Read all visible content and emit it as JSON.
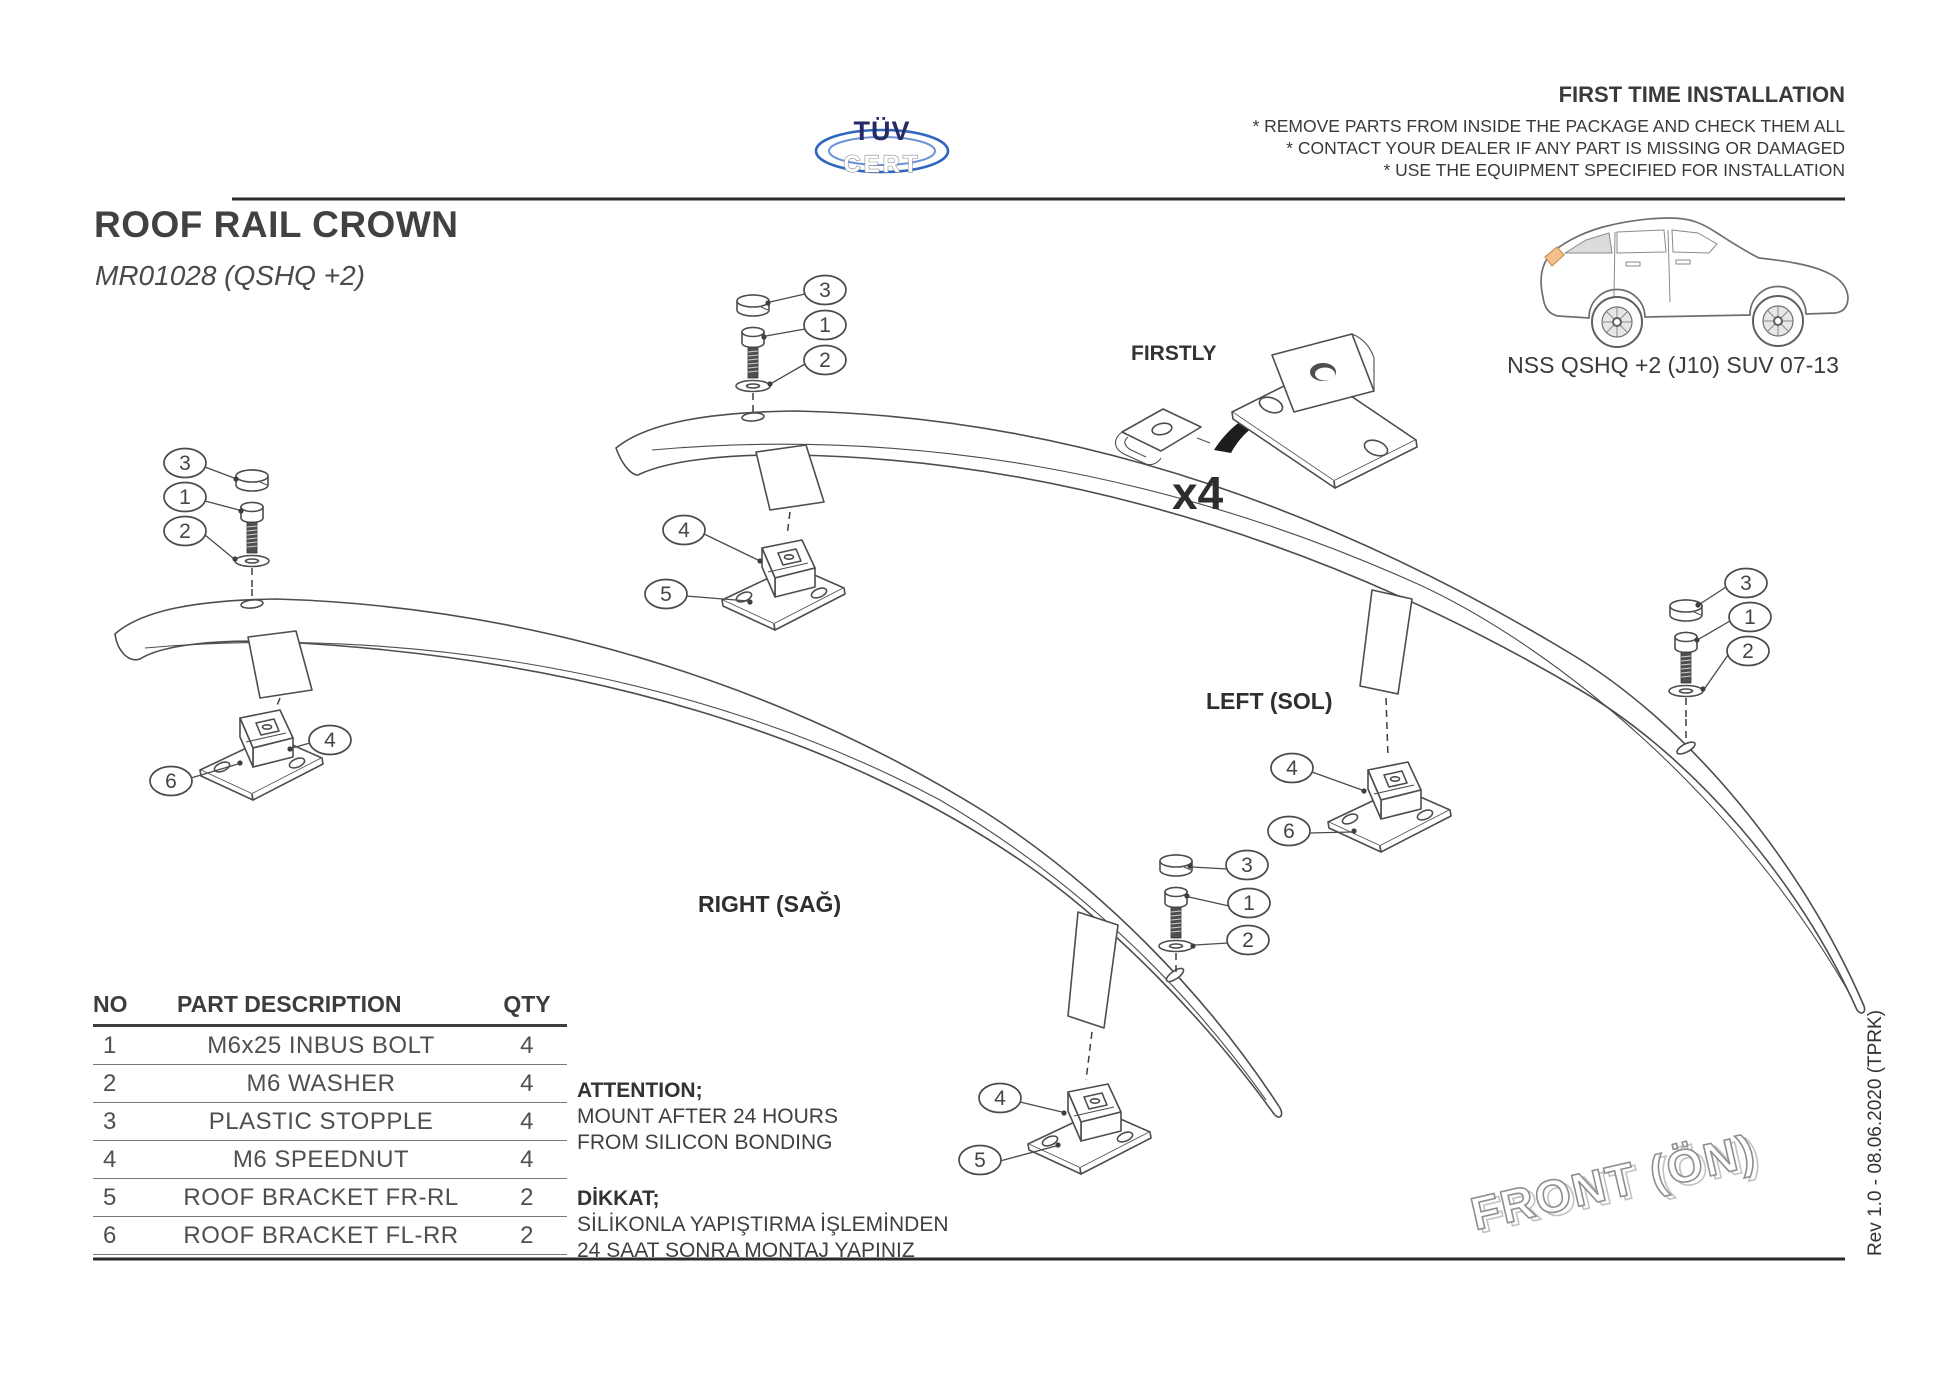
{
  "colors": {
    "accent_blue": "#2f66c0",
    "logo_navy": "#262b66",
    "line_art_gray": "#4d4d4d",
    "text_dark": "#3a3a3a",
    "taillight_orange": "#f5c08a"
  },
  "logo": {
    "tuv": "TÜV",
    "cert": "CERT"
  },
  "header": {
    "first_time_title": "FIRST TIME INSTALLATION",
    "bullets": [
      "* REMOVE PARTS FROM INSIDE THE PACKAGE AND CHECK THEM ALL",
      "* CONTACT YOUR DEALER IF ANY PART IS MISSING OR DAMAGED",
      "* USE THE EQUIPMENT SPECIFIED FOR INSTALLATION"
    ]
  },
  "title": {
    "main": "ROOF RAIL CROWN",
    "sub": "MR01028 (QSHQ +2)"
  },
  "vehicle": {
    "caption": "NSS QSHQ +2 (J10) SUV 07-13"
  },
  "firstly": {
    "label": "FIRSTLY",
    "qty": "x4"
  },
  "rails": {
    "left_label": "LEFT (SOL)",
    "right_label": "RIGHT (SAĞ)"
  },
  "front_label": "FRONT (ÖN)",
  "revision": "Rev 1.0 - 08.06.2020 (TPRK)",
  "parts_table": {
    "headers": {
      "no": "NO",
      "description": "PART DESCRIPTION",
      "qty": "QTY"
    },
    "rows": [
      {
        "no": "1",
        "description": "M6x25 INBUS BOLT",
        "qty": "4"
      },
      {
        "no": "2",
        "description": "M6 WASHER",
        "qty": "4"
      },
      {
        "no": "3",
        "description": "PLASTIC STOPPLE",
        "qty": "4"
      },
      {
        "no": "4",
        "description": "M6 SPEEDNUT",
        "qty": "4"
      },
      {
        "no": "5",
        "description": "ROOF BRACKET FR-RL",
        "qty": "2"
      },
      {
        "no": "6",
        "description": "ROOF BRACKET FL-RR",
        "qty": "2"
      }
    ]
  },
  "notices": {
    "attention_title": "ATTENTION;",
    "attention_lines": [
      "MOUNT AFTER 24 HOURS",
      "FROM SILICON BONDING"
    ],
    "dikkat_title": "DİKKAT;",
    "dikkat_lines": [
      "SİLİKONLA YAPIŞTIRMA İŞLEMİNDEN",
      "24 SAAT SONRA MONTAJ YAPINIZ"
    ]
  },
  "callouts": {
    "lf_bolt": [
      "3",
      "1",
      "2"
    ],
    "rf_bolt": [
      "3",
      "1",
      "2"
    ],
    "lr_bolt": [
      "3",
      "1",
      "2"
    ],
    "rr_bolt": [
      "3",
      "1",
      "2"
    ],
    "lf_bracket": [
      "4",
      "5"
    ],
    "rf_bracket": [
      "4",
      "6"
    ],
    "lr_bracket": [
      "4",
      "6"
    ],
    "rr_bracket": [
      "4",
      "5"
    ]
  }
}
